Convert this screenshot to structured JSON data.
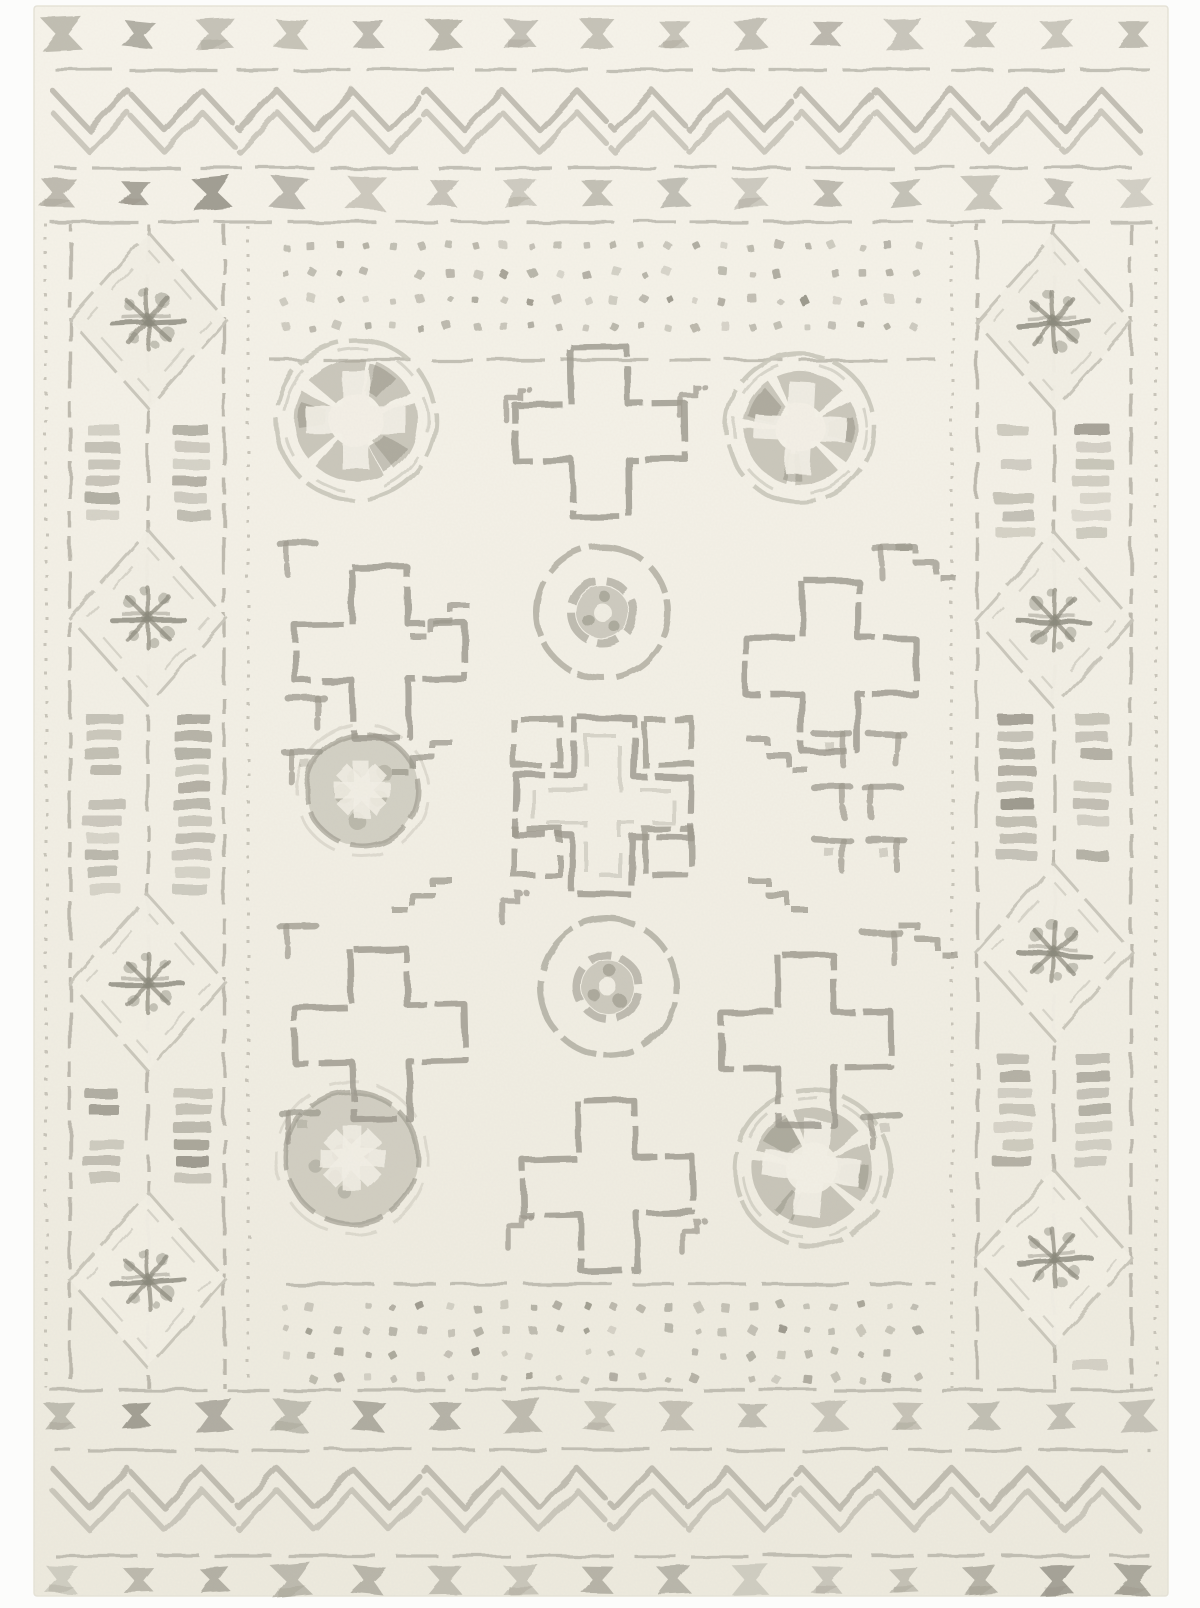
{
  "image": {
    "subject": "cream-and-gray-moroccan-tribal-area-rug",
    "margin_color": "#fcfcfb"
  },
  "palette": {
    "rug_top": "#f6f3ea",
    "rug_mid": "#f2efe5",
    "rug_bottom": "#edeade",
    "rug_edge": "#e6e3d8",
    "line_light": "#c9c6ba",
    "line_soft": "#bcb9ad",
    "line_mid": "#aeab9f",
    "ink_mid": "#9c998d",
    "ink_dark": "#8b897c",
    "fill_gray": "#a7a497",
    "bowtie_shades": [
      "#b5b2a6",
      "#a5a296",
      "#969388"
    ],
    "bar_shades": [
      "#c3c0b4",
      "#aaa79b",
      "#939084",
      "#b7b4a8"
    ],
    "dot_shades": [
      "#a8a599",
      "#949184",
      "#b3b0a4"
    ]
  },
  "rug": {
    "x": 34,
    "y": 6,
    "width": 1134,
    "height": 1590
  },
  "borders": {
    "x_rows": [
      {
        "y": 34,
        "x0": 62,
        "step": 76.5,
        "count": 15
      },
      {
        "y": 193,
        "x0": 58,
        "step": 77,
        "count": 15
      },
      {
        "y": 1416,
        "x0": 60,
        "step": 77,
        "count": 15
      },
      {
        "y": 1580,
        "x0": 62,
        "step": 76.5,
        "count": 15
      }
    ],
    "h_lines": [
      {
        "y": 70,
        "x0": 55,
        "x1": 1150
      },
      {
        "y": 168,
        "x0": 55,
        "x1": 1150
      },
      {
        "y": 222,
        "x0": 50,
        "x1": 1154
      },
      {
        "y": 360,
        "x0": 270,
        "x1": 936
      },
      {
        "y": 1284,
        "x0": 270,
        "x1": 936
      },
      {
        "y": 1390,
        "x0": 50,
        "x1": 1154
      },
      {
        "y": 1450,
        "x0": 55,
        "x1": 1150
      },
      {
        "y": 1556,
        "x0": 55,
        "x1": 1150
      }
    ],
    "zigzags": [
      {
        "ya": 90,
        "yb": 130
      },
      {
        "ya": 112,
        "yb": 152
      },
      {
        "ya": 1468,
        "yb": 1508
      },
      {
        "ya": 1490,
        "yb": 1530
      }
    ],
    "zig_x": {
      "x0": 52,
      "x1": 1154,
      "step": 37.5
    }
  },
  "side_columns": {
    "y0": 224,
    "y1": 1388,
    "left": {
      "center_x": 148,
      "verticals": [
        {
          "x": 46,
          "style": "dotted"
        },
        {
          "x": 70,
          "style": "dashed"
        },
        {
          "x": 148,
          "style": "dashed"
        },
        {
          "x": 224,
          "style": "dashed"
        },
        {
          "x": 248,
          "style": "dotted"
        }
      ],
      "bar_columns": [
        104,
        192
      ],
      "diamond_y": [
        320,
        618,
        983,
        1280
      ]
    },
    "right": {
      "center_x": 1054,
      "verticals": [
        {
          "x": 952,
          "style": "dotted"
        },
        {
          "x": 977,
          "style": "dashed"
        },
        {
          "x": 1054,
          "style": "dashed"
        },
        {
          "x": 1131,
          "style": "dashed"
        },
        {
          "x": 1156,
          "style": "dotted"
        }
      ],
      "bar_columns": [
        1015,
        1093
      ],
      "diamond_y": [
        322,
        620,
        952,
        1258
      ]
    }
  },
  "field": {
    "x0": 262,
    "x1": 940,
    "dot_bands": [
      {
        "rows": [
          246,
          273,
          300,
          327
        ],
        "x0": 284,
        "step": 27.5,
        "count": 24
      },
      {
        "rows": [
          1306,
          1330,
          1354,
          1378
        ],
        "x0": 284,
        "step": 27.5,
        "count": 24
      }
    ]
  },
  "motifs": {
    "cross_half_span": 85,
    "cross_half_arm": 28,
    "circles": [
      {
        "x": 356,
        "y": 420,
        "r": 80,
        "type": "double"
      },
      {
        "x": 800,
        "y": 428,
        "r": 74,
        "type": "double"
      },
      {
        "x": 602,
        "y": 612,
        "r": 66,
        "type": "ring"
      },
      {
        "x": 362,
        "y": 790,
        "r": 62,
        "type": "filled"
      },
      {
        "x": 608,
        "y": 987,
        "r": 68,
        "type": "ring"
      },
      {
        "x": 352,
        "y": 1158,
        "r": 72,
        "type": "filled"
      },
      {
        "x": 812,
        "y": 1168,
        "r": 78,
        "type": "double"
      }
    ],
    "crosses": [
      {
        "x": 600,
        "y": 432
      },
      {
        "x": 380,
        "y": 652
      },
      {
        "x": 830,
        "y": 666
      },
      {
        "x": 603,
        "y": 806,
        "center": true
      },
      {
        "x": 380,
        "y": 1034
      },
      {
        "x": 806,
        "y": 1040
      },
      {
        "x": 608,
        "y": 1186
      }
    ],
    "open_squares": [
      [
        537,
        742
      ],
      [
        668,
        742
      ],
      [
        537,
        852
      ],
      [
        668,
        852
      ]
    ],
    "square_size": 46,
    "steps": [
      [
        452,
        742,
        -1
      ],
      [
        748,
        740,
        1
      ],
      [
        452,
        880,
        -1
      ],
      [
        748,
        880,
        1
      ],
      [
        896,
        548,
        1
      ],
      [
        470,
        606,
        -1
      ],
      [
        898,
        925,
        1
      ]
    ],
    "hooks": [
      [
        516,
        404
      ],
      [
        690,
        400
      ],
      [
        518,
        1232
      ],
      [
        692,
        1236
      ],
      [
        512,
        906
      ]
    ],
    "brackets": [
      [
        300,
        556
      ],
      [
        895,
        560
      ],
      [
        304,
        710
      ],
      [
        304,
        764
      ],
      [
        830,
        746
      ],
      [
        884,
        746
      ],
      [
        830,
        799
      ],
      [
        884,
        799
      ],
      [
        830,
        852
      ],
      [
        884,
        852
      ],
      [
        300,
        938
      ],
      [
        880,
        945
      ],
      [
        302,
        1125
      ],
      [
        884,
        1128
      ]
    ]
  }
}
